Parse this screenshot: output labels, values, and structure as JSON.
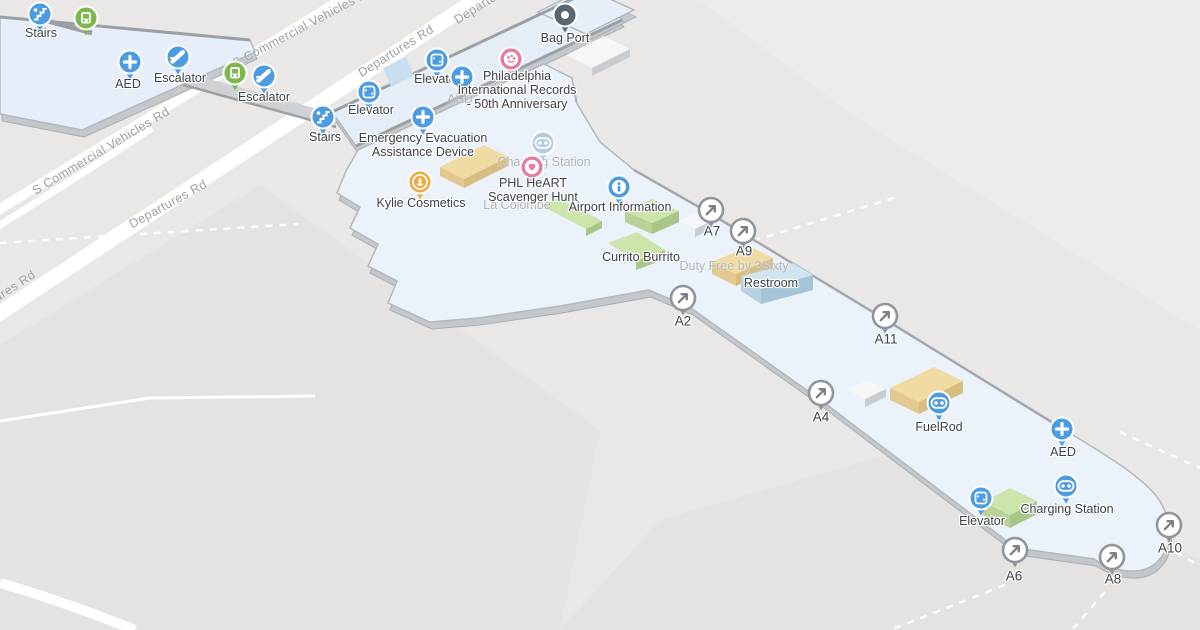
{
  "colors": {
    "background": "#e9e8e6",
    "apron": "#e4e3e1",
    "apron_light": "#edecea",
    "road": "#ffffff",
    "floor": "#eaf1f9",
    "floor_band": "#e5edf7",
    "floor_edge": "#b4b8bc",
    "wall_dark": "#9ba0a4",
    "extrusion": "#c5c8cb",
    "walkway": "#cfd2d5",
    "pin_blue": "#4d9be0",
    "pin_green": "#7cb84e",
    "pin_pink": "#e9799f",
    "pin_amber": "#f0a93c",
    "pin_dark": "#5b6770",
    "pin_faded": "#b6cbdf",
    "gate_ring": "#8f959a",
    "gate_arrow": "#7c8187",
    "label": "#3d4145",
    "label_faded": "#b3b6b9",
    "road_label": "#9ba1a8",
    "building_green_top": "#cde4ab",
    "building_green_side": "#a9c687",
    "building_tan_top": "#f0dba3",
    "building_tan_side": "#d9bc80",
    "building_blue_top": "#cfe3f0",
    "building_blue_side": "#a6c4d8",
    "building_white_top": "#f4f6f8",
    "building_white_side": "#c9cdd1",
    "pool_blue": "#c9ddf0"
  },
  "roads": [
    {
      "text": "Departures Rd",
      "x": 168,
      "y": 204,
      "angle": -29
    },
    {
      "text": "Departures Rd",
      "x": 396,
      "y": 51,
      "angle": -32
    },
    {
      "text": "Departures Rd",
      "x": -2,
      "y": 297,
      "angle": -33
    },
    {
      "text": "Departures Rd",
      "x": 492,
      "y": -2,
      "angle": -32
    },
    {
      "text": "S Commercial Vehicles Rd",
      "x": 101,
      "y": 151,
      "angle": -31
    },
    {
      "text": "S Commercial Vehicles Rd",
      "x": 303,
      "y": 27,
      "angle": -28
    }
  ],
  "pois": [
    {
      "id": "stairs-upper",
      "icon": "stairs",
      "color": "pin_blue",
      "x": 40,
      "y": 14,
      "label": "Stairs",
      "lx": 41,
      "ly": 33
    },
    {
      "id": "shuttle-1",
      "icon": "transit",
      "color": "pin_green",
      "x": 86,
      "y": 18,
      "label": ""
    },
    {
      "id": "aed-west",
      "icon": "plus",
      "color": "pin_blue",
      "x": 130,
      "y": 62,
      "label": "AED",
      "lx": 128,
      "ly": 84
    },
    {
      "id": "escalator-1",
      "icon": "escalator",
      "color": "pin_blue",
      "x": 178,
      "y": 57,
      "label": "Escalator",
      "lx": 180,
      "ly": 78
    },
    {
      "id": "shuttle-2",
      "icon": "transit",
      "color": "pin_green",
      "x": 235,
      "y": 73,
      "label": ""
    },
    {
      "id": "escalator-2",
      "icon": "escalator",
      "color": "pin_blue",
      "x": 264,
      "y": 76,
      "label": "Escalator",
      "lx": 264,
      "ly": 97
    },
    {
      "id": "stairs-mid",
      "icon": "stairs",
      "color": "pin_blue",
      "x": 323,
      "y": 117,
      "label": "Stairs",
      "lx": 325,
      "ly": 137
    },
    {
      "id": "elevator-upper",
      "icon": "elevator",
      "color": "pin_blue",
      "x": 437,
      "y": 60,
      "label": "Elevator",
      "lx": 437,
      "ly": 79
    },
    {
      "id": "elevator-mid",
      "icon": "elevator",
      "color": "pin_blue",
      "x": 369,
      "y": 92,
      "label": "Elevator",
      "lx": 371,
      "ly": 110
    },
    {
      "id": "aed-upper",
      "icon": "plus",
      "color": "pin_blue",
      "x": 462,
      "y": 77,
      "label": "AED",
      "lx": 460,
      "ly": 99,
      "faded_label": true
    },
    {
      "id": "emergency-evac-device",
      "icon": "plus",
      "color": "pin_blue",
      "x": 423,
      "y": 117,
      "label": "Emergency Evacuation\nAssistance Device",
      "lx": 423,
      "ly": 145
    },
    {
      "id": "philadelphia-records",
      "icon": "art",
      "color": "pin_pink",
      "x": 511,
      "y": 59,
      "label": "Philadelphia\nInternational Records\n- 50th Anniversary",
      "lx": 517,
      "ly": 90
    },
    {
      "id": "bag-port",
      "icon": "bag",
      "color": "pin_dark",
      "x": 565,
      "y": 15,
      "label": "Bag Port",
      "lx": 565,
      "ly": 38
    },
    {
      "id": "charging-station-upper",
      "icon": "charging",
      "color": "pin_faded",
      "x": 543,
      "y": 143,
      "label": "Charging Station",
      "lx": 544,
      "ly": 162,
      "faded_label": true
    },
    {
      "id": "phl-heart-scavenger-hunt",
      "icon": "heart",
      "color": "pin_pink",
      "x": 532,
      "y": 167,
      "label": "PHL HeART\nScavenger Hunt",
      "lx": 533,
      "ly": 190
    },
    {
      "id": "kylie-cosmetics",
      "icon": "cosmetics",
      "color": "pin_amber",
      "x": 420,
      "y": 182,
      "label": "Kylie Cosmetics",
      "lx": 421,
      "ly": 203
    },
    {
      "id": "airport-information",
      "icon": "info",
      "color": "pin_blue",
      "x": 619,
      "y": 187,
      "label": "Airport Information",
      "lx": 620,
      "ly": 207
    },
    {
      "id": "fuelrod",
      "icon": "charging",
      "color": "pin_blue",
      "x": 939,
      "y": 403,
      "label": "FuelRod",
      "lx": 939,
      "ly": 427
    },
    {
      "id": "aed-east",
      "icon": "plus",
      "color": "pin_blue",
      "x": 1062,
      "y": 429,
      "label": "AED",
      "lx": 1063,
      "ly": 452
    },
    {
      "id": "charging-station-east",
      "icon": "charging",
      "color": "pin_blue",
      "x": 1066,
      "y": 486,
      "label": "Charging Station",
      "lx": 1067,
      "ly": 509
    },
    {
      "id": "elevator-east",
      "icon": "elevator",
      "color": "pin_blue",
      "x": 981,
      "y": 498,
      "label": "Elevator",
      "lx": 982,
      "ly": 521
    }
  ],
  "gates": [
    {
      "id": "a7",
      "label": "A7",
      "x": 711,
      "y": 210,
      "lx": 712,
      "ly": 231
    },
    {
      "id": "a9",
      "label": "A9",
      "x": 743,
      "y": 231,
      "lx": 744,
      "ly": 251
    },
    {
      "id": "a2",
      "label": "A2",
      "x": 683,
      "y": 298,
      "lx": 683,
      "ly": 321
    },
    {
      "id": "a11",
      "label": "A11",
      "x": 885,
      "y": 316,
      "lx": 886,
      "ly": 339
    },
    {
      "id": "a4",
      "label": "A4",
      "x": 821,
      "y": 393,
      "lx": 821,
      "ly": 417
    },
    {
      "id": "a6",
      "label": "A6",
      "x": 1015,
      "y": 550,
      "lx": 1014,
      "ly": 576
    },
    {
      "id": "a8",
      "label": "A8",
      "x": 1112,
      "y": 557,
      "lx": 1113,
      "ly": 579
    },
    {
      "id": "a10",
      "label": "A10",
      "x": 1169,
      "y": 525,
      "lx": 1170,
      "ly": 548
    }
  ],
  "static_labels": [
    {
      "id": "restroom",
      "text": "Restroom",
      "x": 771,
      "y": 283,
      "faded": false
    },
    {
      "id": "currito-burrito",
      "text": "Currito Burrito",
      "x": 641,
      "y": 257,
      "faded": false
    },
    {
      "id": "duty-free-3sixty",
      "text": "Duty Free by 3Sixty",
      "x": 734,
      "y": 266,
      "faded": true
    },
    {
      "id": "la-colombe",
      "text": "La Colombe",
      "x": 517,
      "y": 205,
      "faded": true
    }
  ]
}
